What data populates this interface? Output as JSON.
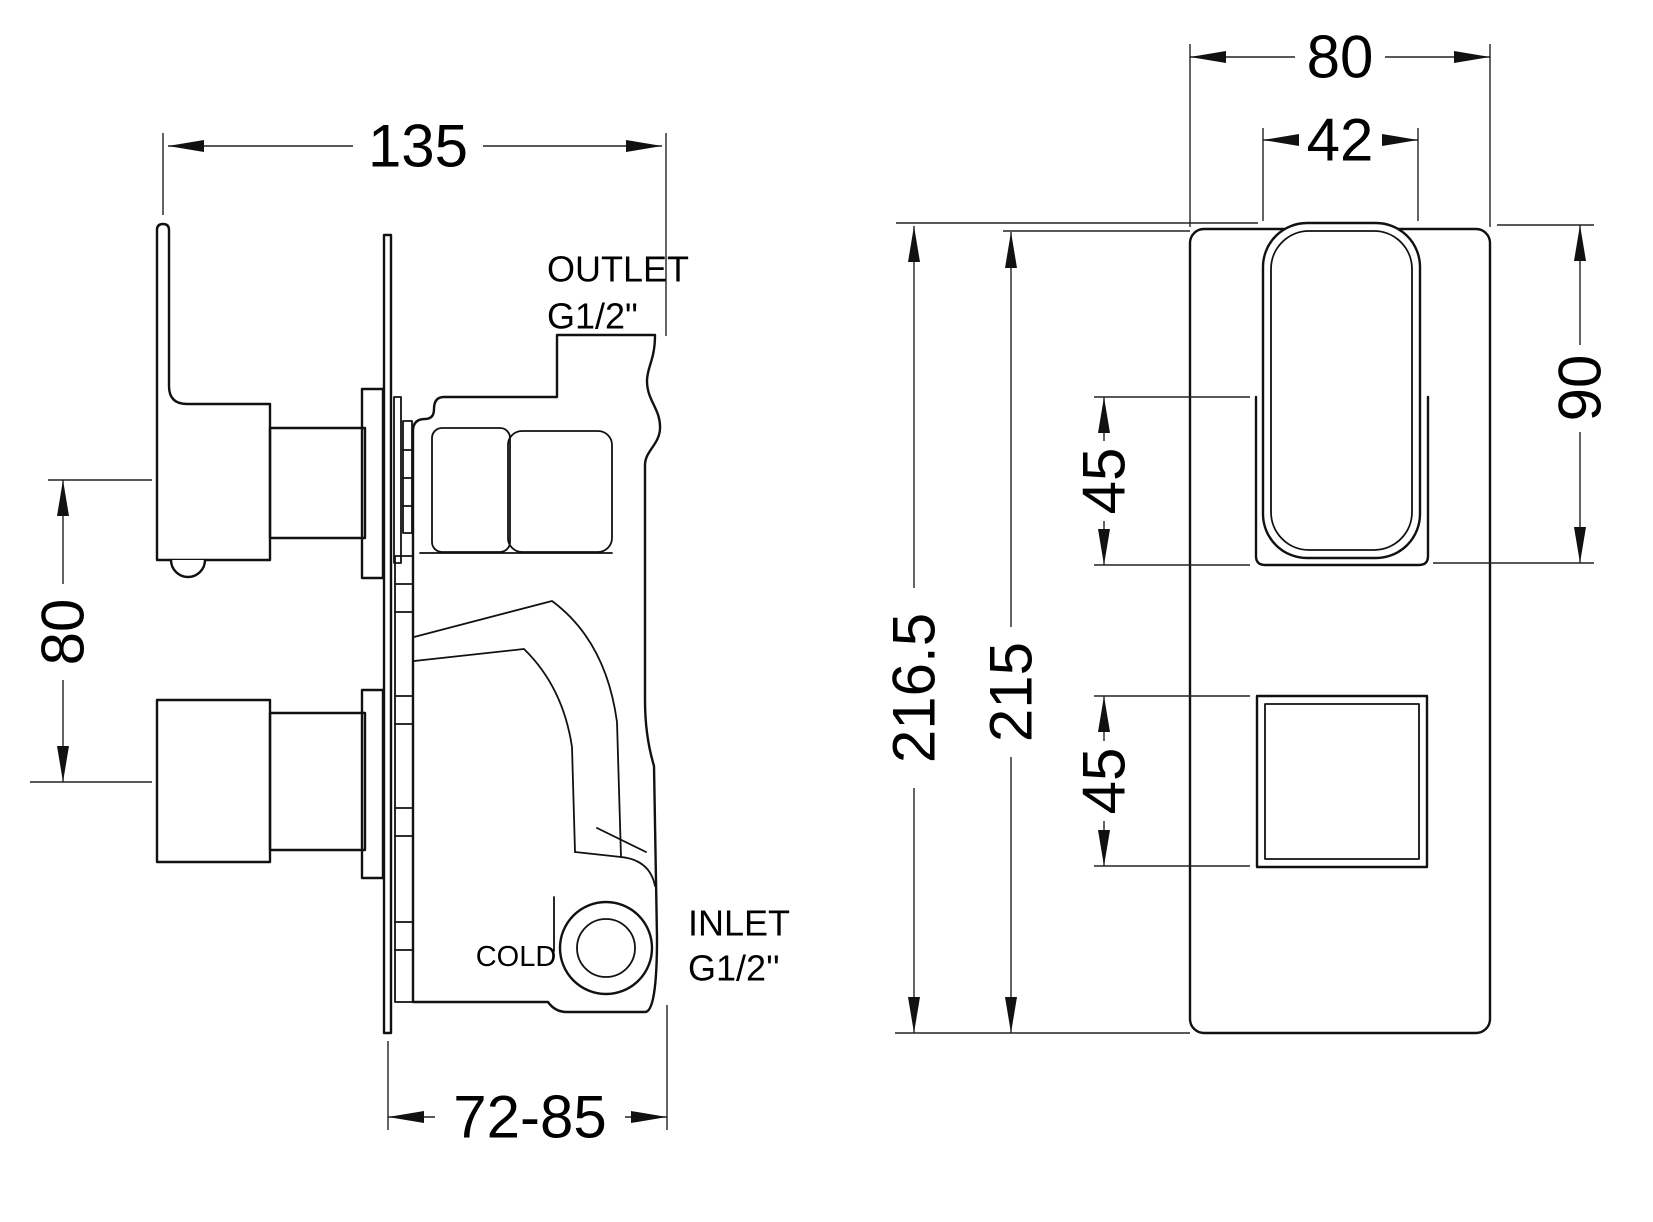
{
  "drawing": {
    "side_view": {
      "labels": {
        "outlet_title": "OUTLET",
        "outlet_thread": "G1/2\"",
        "inlet_title": "INLET",
        "inlet_thread": "G1/2''",
        "cold_port": "COLD"
      },
      "dimensions": {
        "overall_width": "135",
        "handle_spacing": "80",
        "wall_depth_range": "72-85"
      }
    },
    "front_view": {
      "dimensions": {
        "plate_width": "80",
        "lever_width": "42",
        "lever_height": "90",
        "overall_height": "216.5",
        "plate_height": "215",
        "lever_offset": "45",
        "knob_offset": "45"
      }
    },
    "colors": {
      "line": "#111111",
      "background": "#ffffff",
      "text": "#000000"
    }
  }
}
